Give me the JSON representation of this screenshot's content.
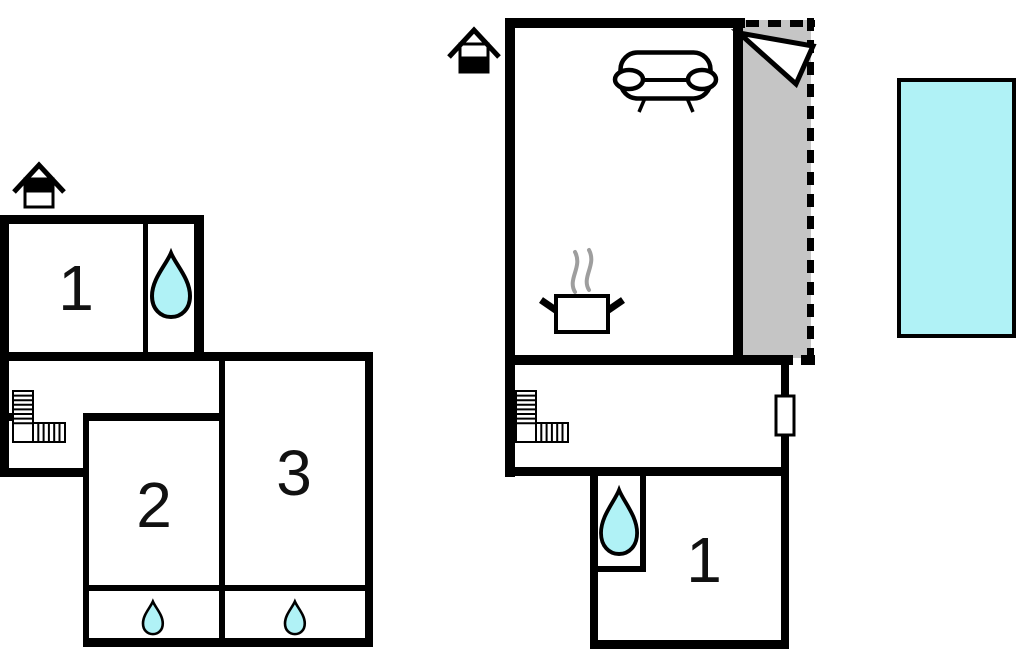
{
  "document": {
    "kind": "floor-plan-drawing",
    "plan_count": 2
  },
  "colors": {
    "wall": "#000000",
    "water": "#b0f2f6",
    "terrace": "#c5c5c5",
    "steam": "#9e9e9e",
    "label": "#111111",
    "background": "#ffffff"
  },
  "floor_plans": {
    "upper_floor": {
      "floor_icon": "house-upper-floor-icon",
      "rooms": [
        {
          "label": "1"
        },
        {
          "label": "2"
        },
        {
          "label": "3"
        }
      ],
      "icons": [
        "house-upper-floor-icon",
        "staircase-icon",
        "water-drop-icon-large",
        "water-drop-icon-small",
        "water-drop-icon-small"
      ]
    },
    "ground_floor": {
      "floor_icon": "house-ground-floor-icon",
      "rooms": [
        {
          "label": "1"
        }
      ],
      "icons": [
        "house-ground-floor-icon",
        "sofa-icon",
        "cooking-pot-icon",
        "steam-icon",
        "staircase-icon",
        "water-drop-icon-large",
        "north-arrow-icon",
        "door-icon"
      ],
      "terrace_present": true
    },
    "pool_present": true
  }
}
